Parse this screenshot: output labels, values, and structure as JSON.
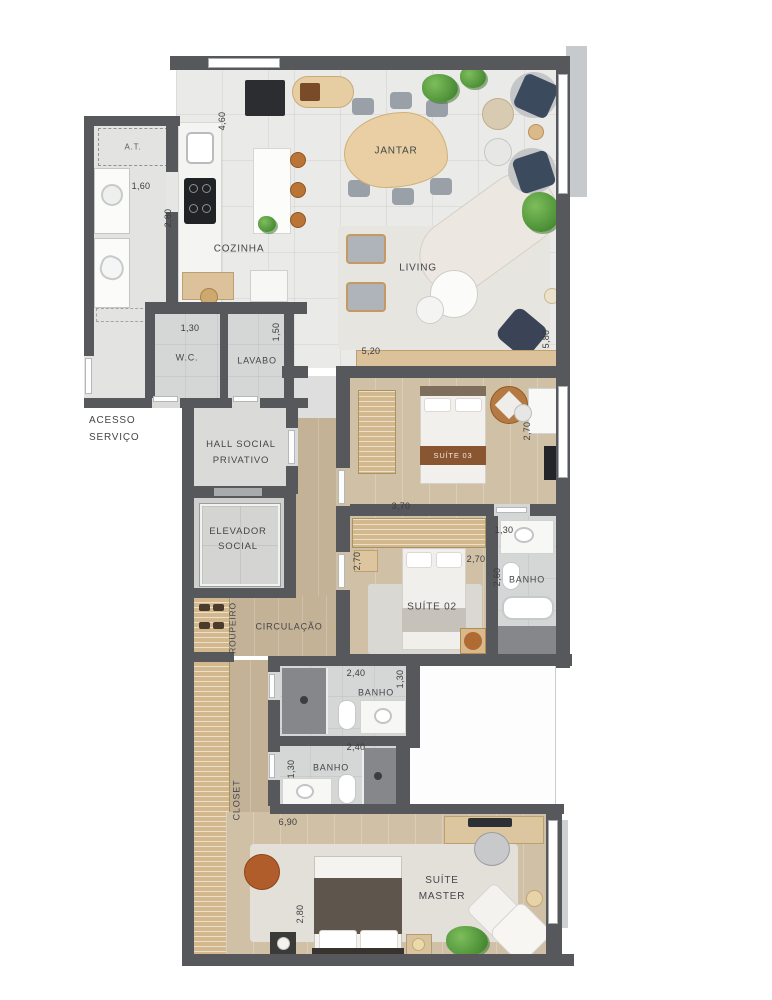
{
  "plan": {
    "rooms": [
      {
        "name": "at",
        "label": "A.T."
      },
      {
        "name": "cozinha",
        "label": "COZINHA"
      },
      {
        "name": "jantar",
        "label": "JANTAR"
      },
      {
        "name": "living",
        "label": "LIVING"
      },
      {
        "name": "wc",
        "label": "W.C."
      },
      {
        "name": "lavabo",
        "label": "LAVABO"
      },
      {
        "name": "acesso-servico",
        "label": "ACESSO SERVIÇO"
      },
      {
        "name": "hall-social",
        "label": "HALL SOCIAL PRIVATIVO"
      },
      {
        "name": "elevador",
        "label": "ELEVADOR SOCIAL"
      },
      {
        "name": "suite-03",
        "label": "SUÍTE 03"
      },
      {
        "name": "banho-suite-03",
        "label": "BANHO"
      },
      {
        "name": "suite-02",
        "label": "SUÍTE 02"
      },
      {
        "name": "circulacao",
        "label": "CIRCULAÇÃO"
      },
      {
        "name": "roupeiro",
        "label": "ROUPEIRO"
      },
      {
        "name": "banho-suite-02",
        "label": "BANHO"
      },
      {
        "name": "banho-master",
        "label": "BANHO"
      },
      {
        "name": "closet",
        "label": "CLOSET"
      },
      {
        "name": "suite-master",
        "label": "SUÍTE MASTER"
      }
    ],
    "dimensions": [
      {
        "text": "4,60",
        "orientation": "vertical"
      },
      {
        "text": "1,60",
        "orientation": "horizontal"
      },
      {
        "text": "2,80",
        "orientation": "vertical"
      },
      {
        "text": "1,30",
        "orientation": "horizontal"
      },
      {
        "text": "1,50",
        "orientation": "vertical"
      },
      {
        "text": "5,20",
        "orientation": "horizontal"
      },
      {
        "text": "5,80",
        "orientation": "vertical"
      },
      {
        "text": "2,70",
        "orientation": "vertical"
      },
      {
        "text": "3,70",
        "orientation": "horizontal"
      },
      {
        "text": "1,30",
        "orientation": "horizontal"
      },
      {
        "text": "2,70",
        "orientation": "vertical"
      },
      {
        "text": "2,70",
        "orientation": "horizontal"
      },
      {
        "text": "2,60",
        "orientation": "vertical"
      },
      {
        "text": "2,40",
        "orientation": "horizontal"
      },
      {
        "text": "1,30",
        "orientation": "vertical"
      },
      {
        "text": "2,40",
        "orientation": "horizontal"
      },
      {
        "text": "1,30",
        "orientation": "vertical"
      },
      {
        "text": "6,90",
        "orientation": "horizontal"
      },
      {
        "text": "2,80",
        "orientation": "vertical"
      }
    ],
    "colors": {
      "wall": "#56585c",
      "tile_floor": "#eaeae8",
      "wood_floor": "#d0c0a6",
      "bath_floor": "#d5d6d6",
      "accent_wood": "#ddc59e",
      "accent_orange": "#b15c2b",
      "accent_navy": "#3c4a5e",
      "shadow_band": "#c6cacd"
    }
  }
}
